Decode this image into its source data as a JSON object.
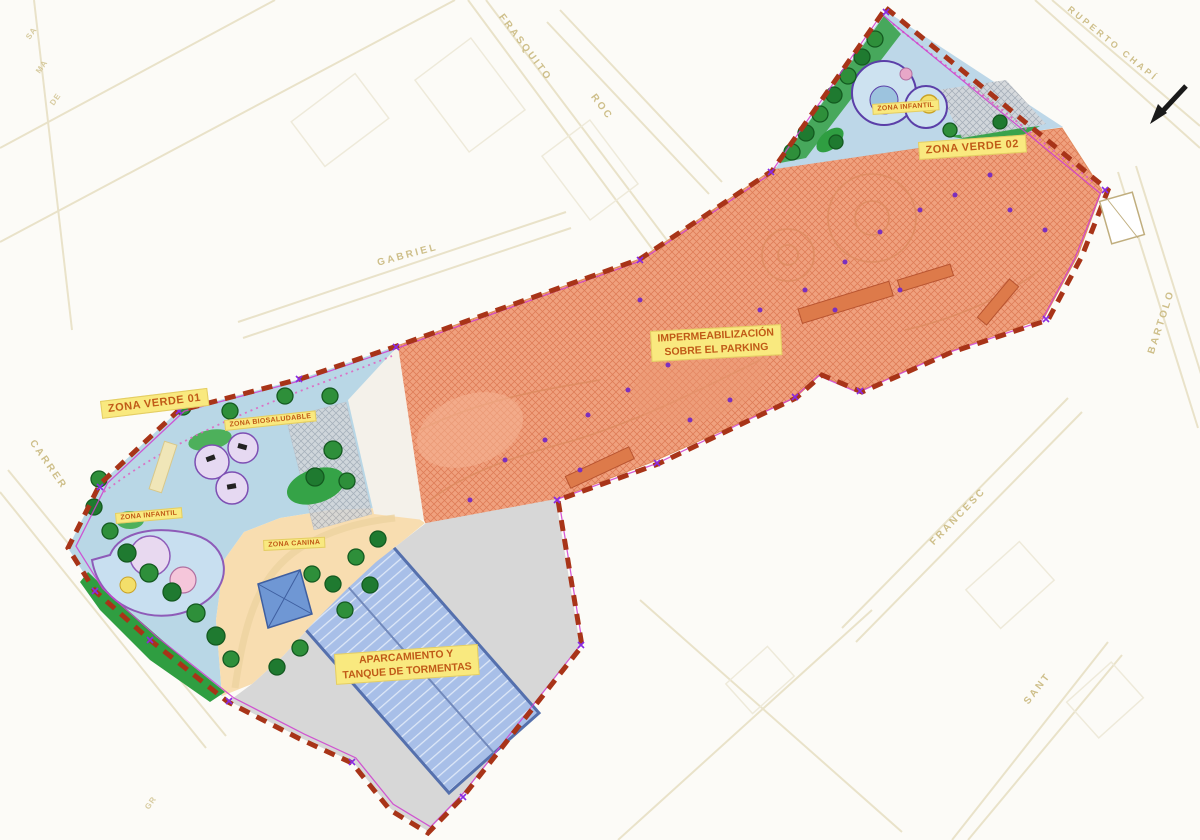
{
  "labels": {
    "zona_verde_01": "ZONA VERDE 01",
    "zona_verde_02": "ZONA VERDE 02",
    "impermeabilizacion_1": "IMPERMEABILIZACIÓN",
    "impermeabilizacion_2": "SOBRE EL PARKING",
    "aparcamiento_1": "APARCAMIENTO Y",
    "aparcamiento_2": "TANQUE DE TORMENTAS",
    "zona_infantil": "ZONA INFANTIL",
    "zona_biosaludable": "ZONA BIOSALUDABLE",
    "zona_canina": "ZONA CANINA"
  },
  "streets": {
    "frasquito": "FRASQUITO",
    "roc": "ROC",
    "ruperto_chapi": "RUPERTO CHAPÍ",
    "gabriel": "GABRIEL",
    "carrer": "CARRER",
    "francesc": "FRANCESC",
    "bartolo": "BARTOLO",
    "sant": "SANT"
  },
  "street_fragments": {
    "f1": "SA",
    "f2": "MA",
    "f3": "DE",
    "f4": "GR"
  },
  "colors": {
    "boundary_dashed": "#a83418",
    "inner_line": "#cf3ecf",
    "impermeabilizacion_fill": "#f0a17e",
    "green_zone_surface": "#b9d7e6",
    "canina_fill": "#f8ddb0",
    "parking_fill": "#d7d7d7",
    "tank_fill": "#a8bfe8",
    "label_bg": "#f9e97f",
    "label_text": "#c05a17",
    "street_text": "#cbbc84"
  }
}
